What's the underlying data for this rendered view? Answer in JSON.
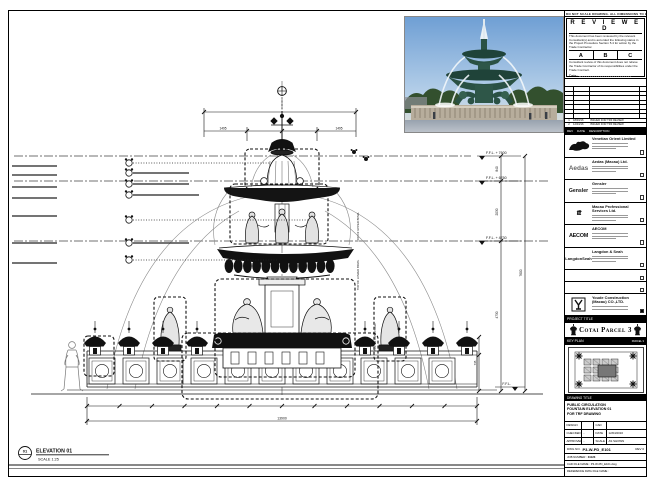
{
  "sheet_note": "DO NOT SCALE DRAWING. ALL DIMENSIONS TO BE VERIFIED ON SITE.",
  "stamp": {
    "title": "R E V I E W E D",
    "body1": "This document has been reviewed by the relevant Consultant(s) and is accorded the following status in the Project Procedure Section 5.4 for action by the Trade Contractor.",
    "options": [
      "A",
      "B",
      "C"
    ],
    "body2": "Consultant review of this document does not relieve the Trade Contractor of its responsibilities under the Trade Contract.",
    "date_label": "Date :"
  },
  "rev_table": {
    "rows": [
      {
        "no": "1",
        "date": "18/03/16",
        "desc": "ISSUED FOR TRF REVIEW"
      },
      {
        "no": "2",
        "date": "12/04/16",
        "desc": "ISSUED FOR TRF REVIEW"
      }
    ],
    "headers": {
      "no": "REV",
      "date": "DATE",
      "desc": "DESCRIPTION"
    }
  },
  "companies": [
    {
      "name": "Venetian Orient Limited"
    },
    {
      "name": "Aedas (Macau) Ltd.",
      "logo_text": "Aedas"
    },
    {
      "name": "Gensler",
      "logo_text": "Gensler"
    },
    {
      "name": "Macau Professional Services Ltd.",
      "logo_text": "ttt"
    },
    {
      "name": "AECOM",
      "logo_text": "AECOM"
    },
    {
      "name": "Langdon & Seah",
      "logo_text": "LangdonSeah"
    }
  ],
  "contractor": {
    "name": "Youde Construction (Macau) CO.,LTD."
  },
  "project": {
    "label": "PROJECT TITLE",
    "title": "Cotai Parcel 3"
  },
  "key_plan": {
    "label": "KEY PLAN",
    "sub": "PARCEL 3"
  },
  "drawing_title": {
    "label": "DRAWING TITLE",
    "line1": "PUBLIC CIRCULATION",
    "line2": "FOUNTAIN ELEVATION 01",
    "line3": "FOR TRF DRAWING"
  },
  "fields": {
    "design_label": "DESIGN",
    "design_value": "",
    "checked_label": "CHECKED",
    "checked_value": "-",
    "approved_label": "APPROVED",
    "approved_value": "-",
    "cad_label": "CAD",
    "cad_value": "",
    "date_label": "DATE",
    "date_value": "12/04/2016",
    "scale_label": "SCALE",
    "scale_value": "AS SHOWN"
  },
  "dwg": {
    "label": "DWG NO.",
    "number": "P3-W-PD_E101",
    "rev_label": "REV",
    "rev_value": "0"
  },
  "job": {
    "label": "JOB NUMBER :",
    "value": "31123"
  },
  "cad_file": {
    "label": "CAD FILE NAME :",
    "value": "P3-W-PD_E101.dwg"
  },
  "ref_file": {
    "label": "REFERENCE DWG FILE NAME :",
    "value": ""
  },
  "elevation_label": {
    "number": "01",
    "title": "ELEVATION 01",
    "scale": "SCALE 1:25"
  },
  "levels": {
    "l1": "F.F.L. + 7600",
    "l2": "F.F.L. + 6760",
    "l3": "F.F.L. + 4730",
    "l4": "F.F.L."
  },
  "dims": {
    "top_left": "1495",
    "top_right": "1495",
    "v1": "840",
    "v2": "2030",
    "v3": "4730",
    "v_total": "7600",
    "lamp_h": "735",
    "bottom_total": "13900"
  },
  "annotations": {
    "a1": "TOP OF UPPER BOWL",
    "a2": "TOP OF LOWER BOWL",
    "a3": "TOP OF BASIN WALL"
  }
}
